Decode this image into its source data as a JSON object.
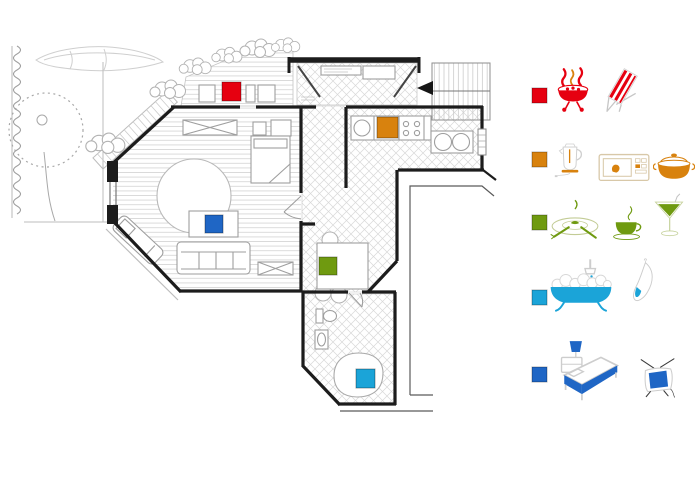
{
  "canvas": {
    "width": 700,
    "height": 500,
    "background": "#ffffff"
  },
  "colors": {
    "red": "#e60010",
    "orange": "#d8820e",
    "green": "#6f9a10",
    "cyan": "#1ba4d8",
    "blue": "#1f66c5",
    "wall": "#1c1c1c",
    "furniture_line": "#9e9e9e",
    "floor_line": "#d2d2d2",
    "garden_line": "#a8a8a8"
  },
  "floor_plan": {
    "rooms": [
      "terrace",
      "living-bedroom",
      "entry-hall",
      "kitchen",
      "dining-area",
      "bathroom",
      "staircase",
      "side-terrace",
      "garden"
    ],
    "garden_features": [
      "tree",
      "stone-wall",
      "rowboat",
      "shrubs",
      "outdoor-stairs"
    ],
    "markers": [
      {
        "id": "terrace-marker",
        "room": "terrace",
        "color": "red",
        "x": 222,
        "y": 82
      },
      {
        "id": "kitchen-marker",
        "room": "kitchen",
        "color": "orange",
        "x": 377,
        "y": 117
      },
      {
        "id": "living-marker",
        "room": "living-bedroom",
        "color": "blue",
        "x": 205,
        "y": 215
      },
      {
        "id": "dining-marker",
        "room": "dining-area",
        "color": "green",
        "x": 319,
        "y": 257
      },
      {
        "id": "bathroom-marker",
        "room": "bathroom",
        "color": "cyan",
        "x": 356,
        "y": 369
      }
    ]
  },
  "legend": {
    "rows": [
      {
        "key": "red",
        "icons": [
          "bbq-grill-icon",
          "deck-chair-icon"
        ]
      },
      {
        "key": "orange",
        "icons": [
          "kettle-icon",
          "microwave-icon",
          "cooking-pot-icon"
        ]
      },
      {
        "key": "green",
        "icons": [
          "place-setting-icon",
          "tea-cup-icon",
          "cocktail-icon"
        ]
      },
      {
        "key": "cyan",
        "icons": [
          "bathtub-icon",
          "towel-icon"
        ]
      },
      {
        "key": "blue",
        "icons": [
          "bed-icon",
          "tv-icon"
        ]
      }
    ]
  }
}
